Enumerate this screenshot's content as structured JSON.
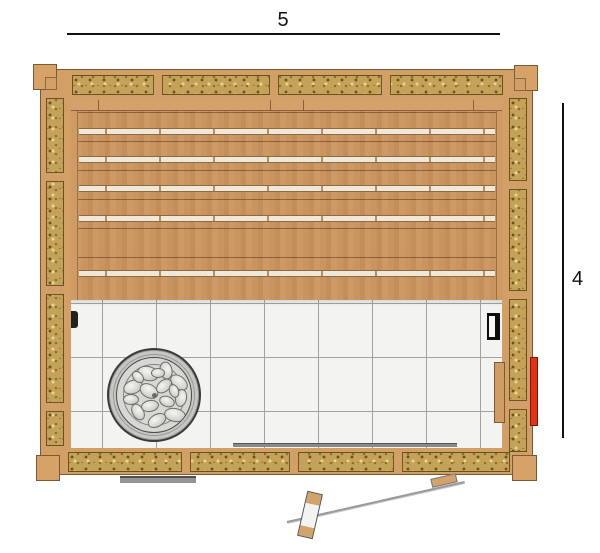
{
  "dimensions": {
    "width_label": "5",
    "height_label": "4"
  },
  "palette": {
    "frame_wood": "#d29f66",
    "bench_wood": "#ca9460",
    "insulation_fill": "#c4a258",
    "tile_floor": "#f3f3f1",
    "heater_stone": "#d8d7d3",
    "vent_red": "#e23312",
    "dimension_line": "#111111"
  }
}
